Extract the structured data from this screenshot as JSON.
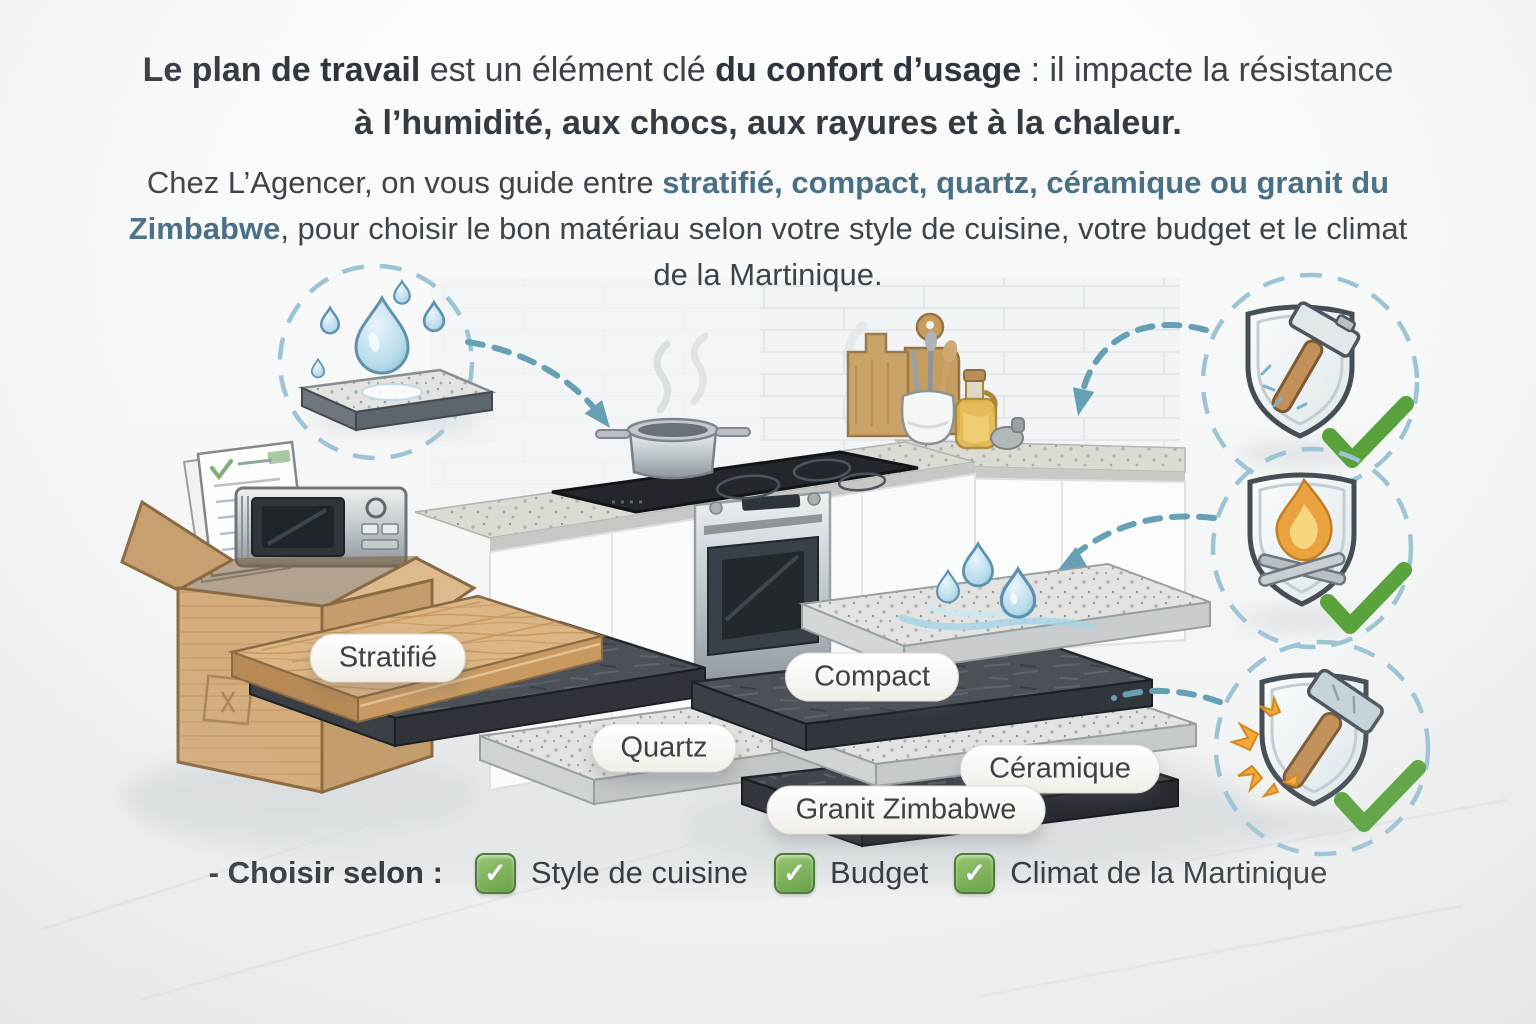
{
  "heading": {
    "line1": {
      "bold1": "Le plan de travail",
      "regular1": " est un élément clé ",
      "bold2": "du confort d’usage",
      "regular2": " : il impacte la résistance"
    },
    "line2": "à l’humidité, aux chocs, aux rayures et à la chaleur."
  },
  "intro": {
    "part1": "Chez L’Agencer, on vous guide entre ",
    "materials_accent": "stratifié, compact, quartz, céramique ou granit du Zimbabwe",
    "part2": ", pour choisir le bon matériau selon votre style de cuisine, votre budget et le climat de la Martinique."
  },
  "material_labels": {
    "stratifie": "Stratifié",
    "quartz": "Quartz",
    "compact": "Compact",
    "ceramique": "Céramique",
    "granit": "Granit Zimbabwe"
  },
  "icons": {
    "humidity": "water-drops-on-countertop-icon",
    "impact": "shield-hammer-check-icon",
    "heat": "shield-flame-check-icon",
    "scratch": "shield-hammer-sparks-check-icon",
    "approval": "green-check-icon",
    "checkbox": "green-checkbox-icon"
  },
  "checklist": {
    "prefix": "- Choisir selon :",
    "checkmark": "✓",
    "items": [
      "Style de cuisine",
      "Budget",
      "Climat de la Martinique"
    ]
  },
  "colors": {
    "accent_blue": "#4a7086",
    "text_dark": "#343b42",
    "dashed_circle_blue": "#9dc4d5",
    "arrow_blue": "#66a0b5",
    "check_green": "#59a23b",
    "checkbox_green": "#6aa14a"
  }
}
